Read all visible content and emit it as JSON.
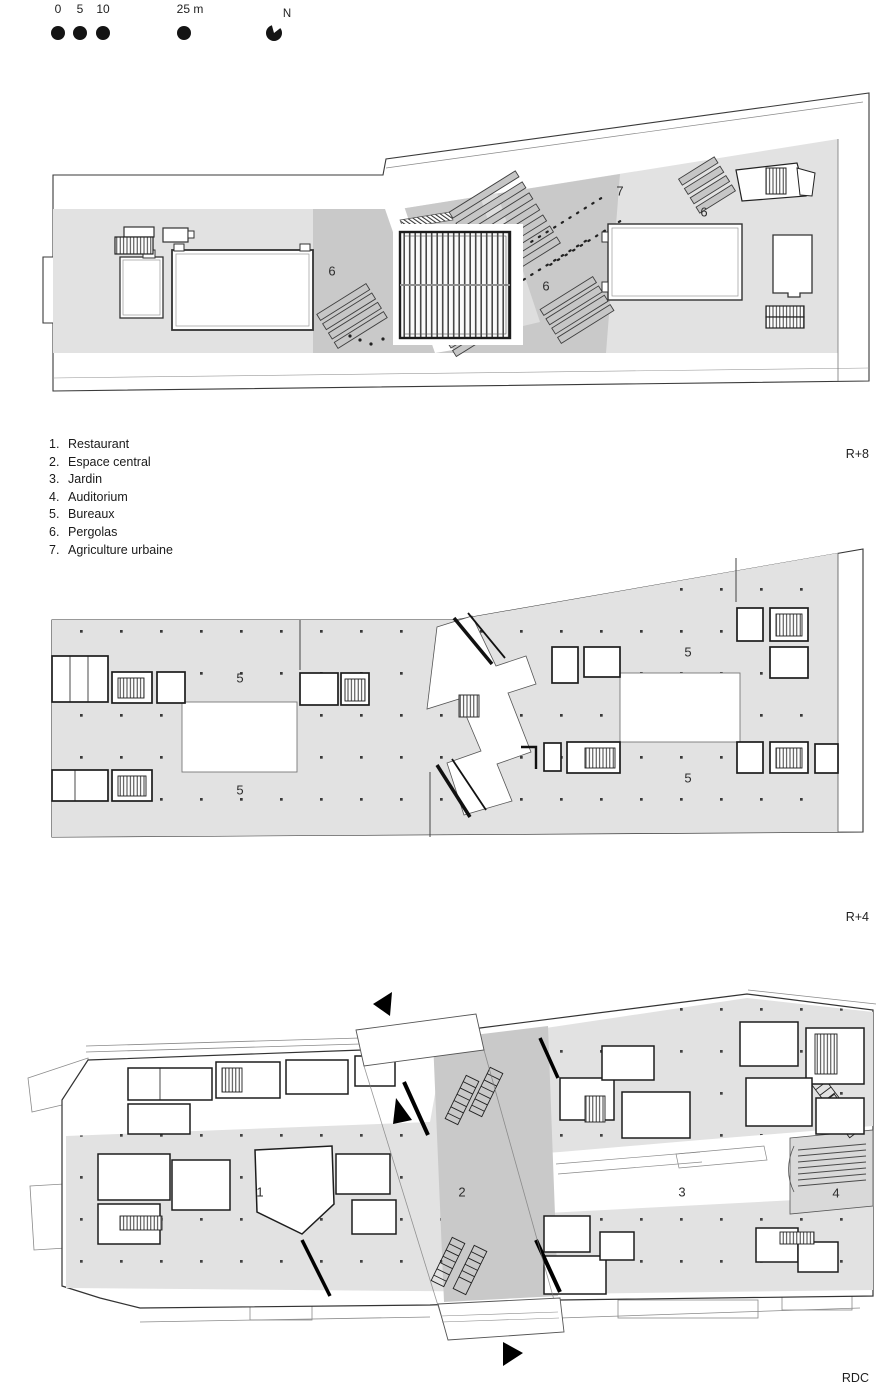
{
  "scale_bar": {
    "tick_0": "0",
    "tick_5": "5",
    "tick_10": "10",
    "tick_25": "25 m",
    "north_label": "N"
  },
  "legend": {
    "items": [
      {
        "number": "1.",
        "label": "Restaurant"
      },
      {
        "number": "2.",
        "label": "Espace central"
      },
      {
        "number": "3.",
        "label": "Jardin"
      },
      {
        "number": "4.",
        "label": "Auditorium"
      },
      {
        "number": "5.",
        "label": "Bureaux"
      },
      {
        "number": "6.",
        "label": "Pergolas"
      },
      {
        "number": "7.",
        "label": "Agriculture urbaine"
      }
    ]
  },
  "plans": [
    {
      "id": "R+8",
      "level_label": "R+8",
      "annotations": [
        {
          "text": "6"
        },
        {
          "text": "7"
        },
        {
          "text": "6"
        },
        {
          "text": "6"
        }
      ]
    },
    {
      "id": "R+4",
      "level_label": "R+4",
      "annotations": [
        {
          "text": "5"
        },
        {
          "text": "5"
        },
        {
          "text": "5"
        },
        {
          "text": "5"
        }
      ]
    },
    {
      "id": "RDC",
      "level_label": "RDC",
      "annotations": [
        {
          "text": "1"
        },
        {
          "text": "2"
        },
        {
          "text": "3"
        },
        {
          "text": "4"
        }
      ]
    }
  ],
  "colors": {
    "roof_gray": "#e2e2e2",
    "terrace_gray": "#c9c9c9",
    "line": "#2f2f2f"
  }
}
